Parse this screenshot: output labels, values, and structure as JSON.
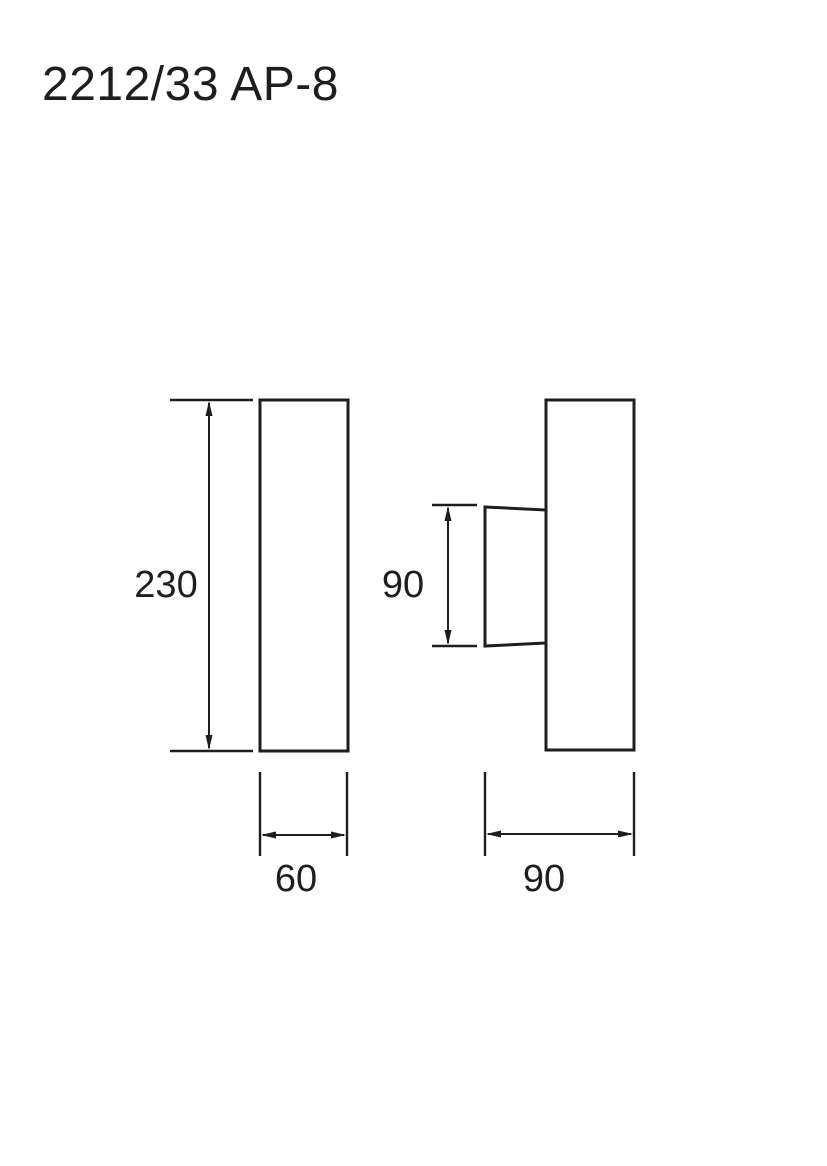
{
  "title": "2212/33 AP-8",
  "colors": {
    "line": "#1f1d1e",
    "background": "#ffffff"
  },
  "drawing": {
    "front_view": {
      "height_label": "230",
      "width_label": "60"
    },
    "side_view": {
      "body_height_label": "90",
      "depth_label": "90"
    }
  }
}
